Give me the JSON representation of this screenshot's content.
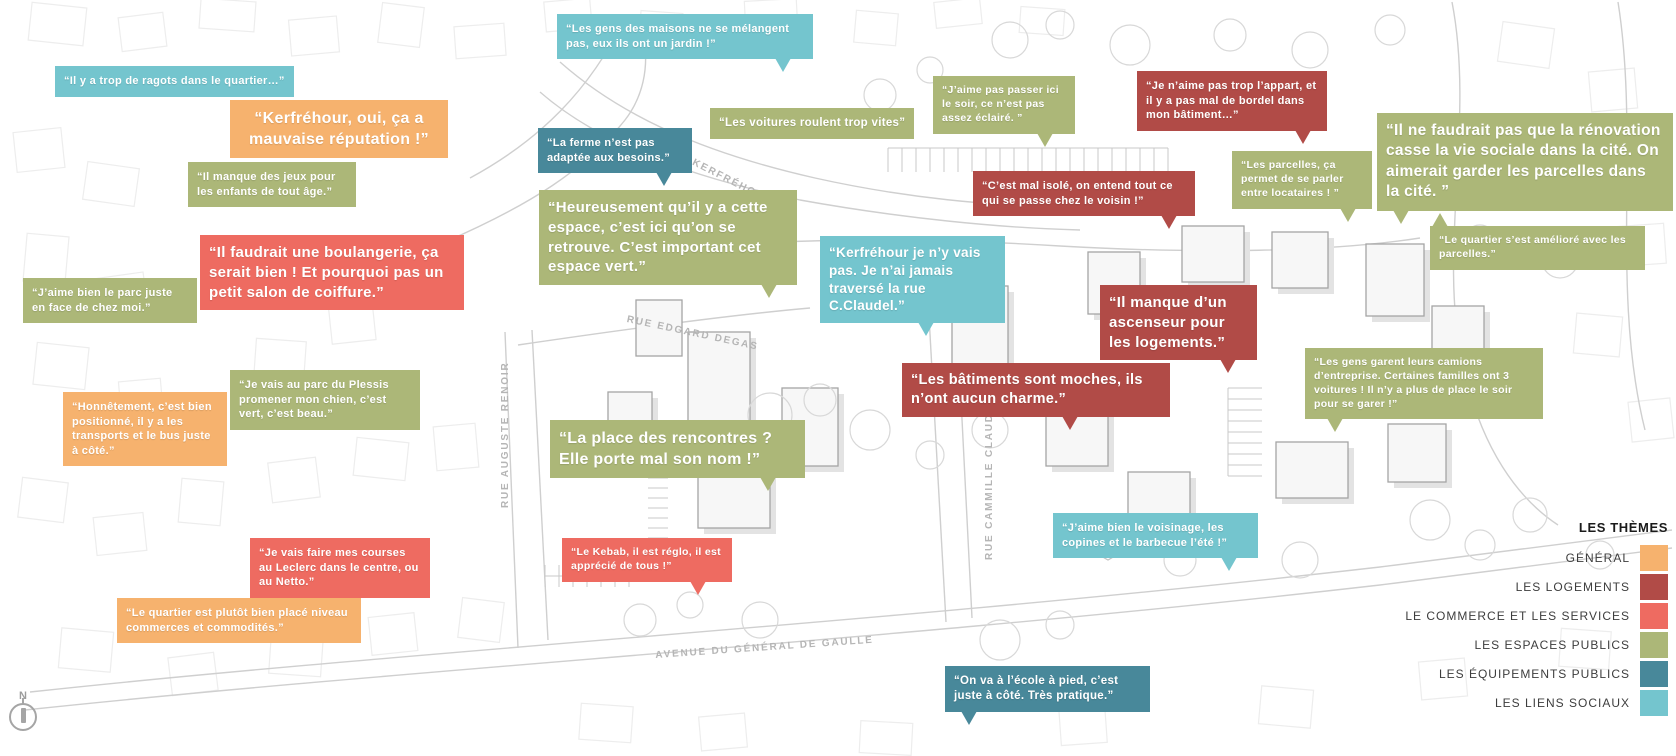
{
  "legend": {
    "title": "LES THÈMES",
    "items": [
      {
        "key": "general",
        "label": "GÉNÉRAL",
        "color": "#F6B26E"
      },
      {
        "key": "logements",
        "label": "LES LOGEMENTS",
        "color": "#B14B47"
      },
      {
        "key": "commerce",
        "label": "LE COMMERCE ET LES SERVICES",
        "color": "#EE6B61"
      },
      {
        "key": "espaces",
        "label": "LES ESPACES PUBLICS",
        "color": "#ACB778"
      },
      {
        "key": "equipements",
        "label": "LES ÉQUIPEMENTS PUBLICS",
        "color": "#48889A"
      },
      {
        "key": "liens",
        "label": "LES LIENS SOCIAUX",
        "color": "#74C5CE"
      }
    ]
  },
  "compass": {
    "label": "N"
  },
  "streets": [
    {
      "id": "rue-de-kerfrehour",
      "name": "RUE DE KERFRÉHOUR",
      "x": 648,
      "y": 133,
      "rotate": 27
    },
    {
      "id": "rue-edgard-degas",
      "name": "RUE EDGARD DEGAS",
      "x": 628,
      "y": 314,
      "rotate": 12
    },
    {
      "id": "rue-auguste-renoir",
      "name": "RUE AUGUSTE RENOIR",
      "x": 500,
      "y": 508,
      "rotate": -90
    },
    {
      "id": "rue-cammille-claudel",
      "name": "RUE CAMMILLE CLAUDEL",
      "x": 984,
      "y": 560,
      "rotate": -90
    },
    {
      "id": "avenue-de-gaulle",
      "name": "AVENUE DU GÉNÉRAL DE GAULLE",
      "x": 655,
      "y": 650,
      "rotate": -4
    }
  ],
  "bubbles": [
    {
      "id": "ragots",
      "theme": "liens",
      "x": 55,
      "y": 66,
      "fs": 11,
      "nowrap": true,
      "text": "“Il y a trop de ragots dans le quartier…”"
    },
    {
      "id": "gens-des-maisons",
      "theme": "liens",
      "x": 557,
      "y": 14,
      "w": 256,
      "fs": 11,
      "text": "“Les gens des maisons ne se mélangent pas, eux ils ont un jardin !”",
      "tail": {
        "side": "bottom",
        "left": 218
      }
    },
    {
      "id": "mauvaise-reputation",
      "theme": "general",
      "x": 230,
      "y": 100,
      "w": 218,
      "fs": 16,
      "align": "center",
      "text": "“Kerfréhour, oui, ça a mauvaise réputation !”"
    },
    {
      "id": "jeux-enfants",
      "theme": "espaces",
      "x": 188,
      "y": 162,
      "w": 168,
      "fs": 11,
      "text": "“Il manque des jeux pour les enfants de tout âge.”"
    },
    {
      "id": "voitures-vites",
      "theme": "espaces",
      "x": 710,
      "y": 108,
      "fs": 11.5,
      "nowrap": true,
      "text": "“Les voitures roulent trop vites”"
    },
    {
      "id": "ferme",
      "theme": "equipements",
      "x": 538,
      "y": 128,
      "w": 154,
      "fs": 11,
      "text": "“La ferme n’est pas adaptée aux besoins.”",
      "tail": {
        "side": "bottom",
        "left": 118
      }
    },
    {
      "id": "espace-vert",
      "theme": "espaces",
      "x": 539,
      "y": 190,
      "w": 258,
      "fs": 15,
      "text": "“Heureusement qu’il y a cette espace, c’est ici qu’on se retrouve. C’est important cet espace vert.”",
      "tail": {
        "side": "bottom",
        "left": 222
      }
    },
    {
      "id": "boulangerie",
      "theme": "commerce",
      "x": 200,
      "y": 235,
      "w": 264,
      "fs": 15,
      "text": "“Il faudrait une boulangerie, ça serait bien ! Et pourquoi pas un petit salon de coiffure.”"
    },
    {
      "id": "parc-en-face",
      "theme": "espaces",
      "x": 23,
      "y": 278,
      "w": 174,
      "fs": 11,
      "text": "“J’aime bien le parc juste en face de chez moi.”"
    },
    {
      "id": "parc-du-plessis",
      "theme": "espaces",
      "x": 230,
      "y": 370,
      "w": 190,
      "fs": 11,
      "text": "“Je vais au parc du Plessis promener mon chien, c’est vert, c’est beau.”"
    },
    {
      "id": "bien-positionne",
      "theme": "general",
      "x": 63,
      "y": 392,
      "w": 164,
      "fs": 11,
      "text": "“Honnêtement, c’est bien positionné, il y a les transports et le bus juste à côté.”"
    },
    {
      "id": "courses-leclerc",
      "theme": "commerce",
      "x": 250,
      "y": 538,
      "w": 180,
      "fs": 11,
      "text": "“Je vais faire mes courses au Leclerc dans le centre, ou au Netto.”"
    },
    {
      "id": "bien-place",
      "theme": "general",
      "x": 117,
      "y": 598,
      "w": 244,
      "fs": 11,
      "text": "“Le quartier est plutôt bien placé niveau commerces et commodités.”"
    },
    {
      "id": "kebab",
      "theme": "commerce",
      "x": 562,
      "y": 538,
      "w": 170,
      "fs": 10.5,
      "text": "“Le Kebab, il est réglo, il est apprécié de tous !”",
      "tail": {
        "side": "bottom",
        "left": 128
      }
    },
    {
      "id": "place-rencontres",
      "theme": "espaces",
      "x": 550,
      "y": 420,
      "w": 255,
      "fs": 16,
      "text": "“La place des rencontres ? Elle porte mal son nom !”",
      "tail": {
        "side": "bottom",
        "left": 210
      }
    },
    {
      "id": "rue-claudel",
      "theme": "liens",
      "x": 820,
      "y": 236,
      "w": 185,
      "fs": 13.5,
      "text": "“Kerfréhour je n’y vais pas. Je n’ai jamais traversé la rue C.Claudel.”",
      "tail": {
        "side": "bottom",
        "left": 98
      }
    },
    {
      "id": "batiments-moches",
      "theme": "logements",
      "x": 902,
      "y": 363,
      "w": 268,
      "fs": 14.5,
      "text": "“Les bâtiments sont moches, ils n’ont aucun charme.”",
      "tail": {
        "side": "bottom",
        "left": 160
      }
    },
    {
      "id": "pas-eclaire",
      "theme": "espaces",
      "x": 933,
      "y": 76,
      "w": 142,
      "fs": 10.5,
      "text": "“J’aime pas passer ici le soir, ce n’est pas assez éclairé. ”",
      "tail": {
        "side": "bottom",
        "left": 104
      }
    },
    {
      "id": "mal-isole",
      "theme": "logements",
      "x": 973,
      "y": 171,
      "w": 222,
      "fs": 11,
      "text": "“C’est mal isolé, on entend tout ce qui se passe chez le voisin !”",
      "tail": {
        "side": "bottom",
        "left": 188
      }
    },
    {
      "id": "appart-bordel",
      "theme": "logements",
      "x": 1137,
      "y": 71,
      "w": 190,
      "fs": 11,
      "text": "“Je n’aime pas trop l’appart, et il y a pas mal de bordel dans mon bâtiment…”",
      "tail": {
        "side": "bottom",
        "left": 158
      }
    },
    {
      "id": "parcelles-parler",
      "theme": "espaces",
      "x": 1232,
      "y": 151,
      "w": 140,
      "fs": 10.5,
      "text": "“Les parcelles, ça permet de se parler entre locataires ! ”",
      "tail": {
        "side": "bottom",
        "left": 108
      }
    },
    {
      "id": "renovation",
      "theme": "espaces",
      "x": 1377,
      "y": 113,
      "w": 296,
      "fs": 15.5,
      "text": "“Il ne faudrait pas que la rénovation casse la vie sociale dans la cité. On aimerait garder les parcelles dans la cité. ”",
      "tail": {
        "side": "bottom",
        "left": 16
      }
    },
    {
      "id": "quartier-ameliore",
      "theme": "espaces",
      "x": 1430,
      "y": 226,
      "w": 215,
      "fs": 10.5,
      "text": "“Le quartier s’est amélioré avec les parcelles.”",
      "tail": {
        "side": "top",
        "left": 2
      }
    },
    {
      "id": "ascenseur",
      "theme": "logements",
      "x": 1100,
      "y": 285,
      "w": 157,
      "fs": 15,
      "text": "“Il manque d’un ascenseur pour les logements.”",
      "tail": {
        "side": "bottom",
        "left": 120
      }
    },
    {
      "id": "camions",
      "theme": "espaces",
      "x": 1305,
      "y": 348,
      "w": 238,
      "fs": 10.5,
      "text": "“Les gens garent leurs camions d’entreprise. Certaines familles ont 3 voitures ! Il n’y a plus de place le soir pour se garer !”",
      "tail": {
        "side": "bottom",
        "left": 22
      }
    },
    {
      "id": "voisinage-barbecue",
      "theme": "liens",
      "x": 1053,
      "y": 513,
      "w": 205,
      "fs": 11,
      "text": "“J’aime bien le voisinage, les copines et le barbecue l’été !”",
      "tail": {
        "side": "bottom",
        "left": 168
      }
    },
    {
      "id": "ecole-a-pied",
      "theme": "equipements",
      "x": 945,
      "y": 666,
      "w": 205,
      "fs": 11.5,
      "text": "“On va à l’école à pied, c’est juste à côté. Très pratique.”",
      "tail": {
        "side": "bottom",
        "left": 16
      }
    }
  ]
}
